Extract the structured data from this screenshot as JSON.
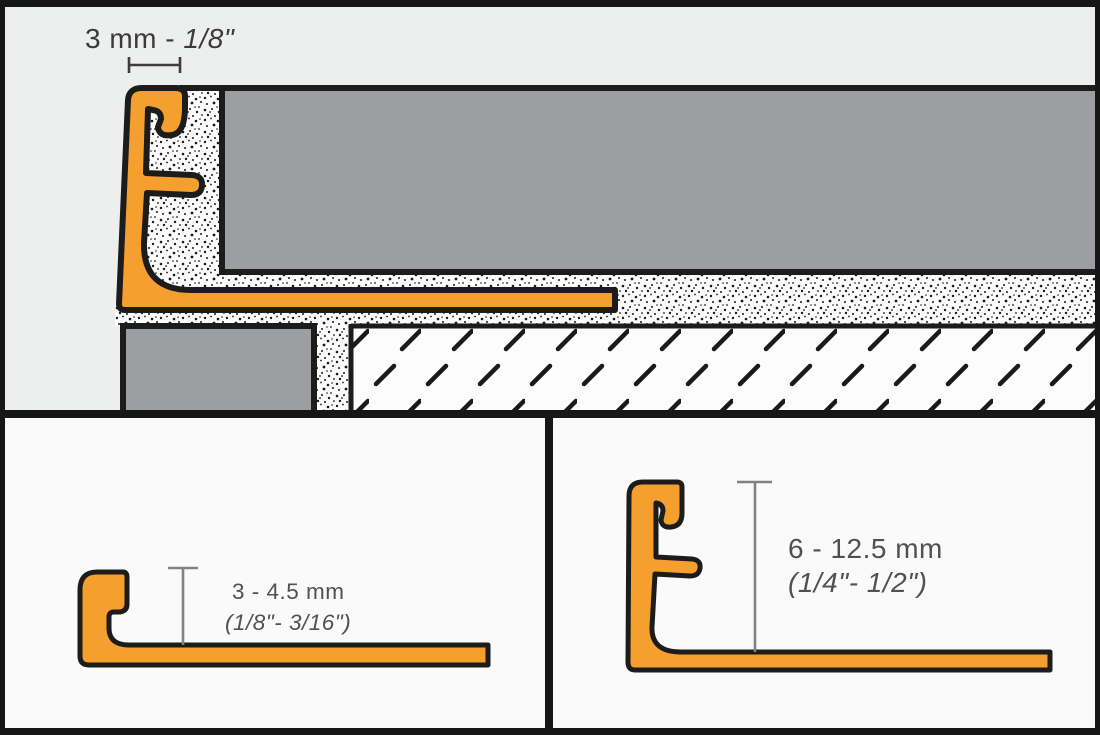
{
  "top_panel": {
    "dim_prefix": "3 mm - ",
    "dim_inches": "1/8\""
  },
  "bottom_left_panel": {
    "size_metric": "3 - 4.5 mm",
    "size_imperial": "(1/8\"- 3/16\")"
  },
  "bottom_right_panel": {
    "size_metric": "6 - 12.5 mm",
    "size_imperial": "(1/4\"- 1/2\")"
  },
  "colors": {
    "frame_black": "#161616",
    "panel_bg_top": "#EDEEEE",
    "panel_bg_bottom": "#FAFAFA",
    "profile_orange": "#F5A02E",
    "tile_gray": "#9C9EA1",
    "outline_black": "#1C1C1A",
    "stipple_bg": "#FCFCFC",
    "stipple_dot": "#1A1A1A",
    "hatch_bg": "#FCFCFC",
    "hatch_dash": "#1A1A1A",
    "dim_dark": "#3D3D3D",
    "dim_gray": "#828282",
    "text_dark": "#3A3A3A",
    "text_gray": "#515151"
  }
}
